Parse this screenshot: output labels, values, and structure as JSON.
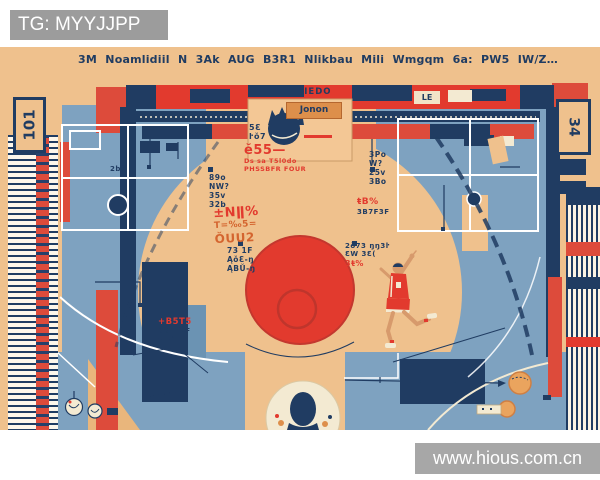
{
  "banners": {
    "telegram": "TG: MYYJJPP",
    "website": "www.hious.com.cn"
  },
  "illustration": {
    "top_words": [
      "3M",
      "Noamlidiil",
      "N",
      "3Ak",
      "AUG",
      "B3R1",
      "Nlikbau",
      "Mili",
      "Wmgqm",
      "6a:",
      "PW5",
      "IW/Z…"
    ],
    "corner_left": "101",
    "corner_right": "34",
    "band": {
      "jonon": "Jonon",
      "piedo": "PIEDO",
      "le": "LE"
    },
    "annotations": {
      "center": {
        "l1": "ĕ55—",
        "l2": "Ds sa T5l0do",
        "l3": "PHSSBFR FOUR"
      },
      "left_red": {
        "l1": "±Nǁ%",
        "l2": "T=‰5=",
        "l3": "ŎUU2"
      },
      "left_navy": {
        "l1": "89o",
        "l2": "NW?",
        "l3": "35v",
        "l4": "32b"
      },
      "mid_navy": {
        "l1": "5Ɛ",
        "l2": "ŀŏ7"
      },
      "right_navy": {
        "l1": "3Po",
        "l2": "W?",
        "l3": "25v",
        "l4": "3Bo"
      },
      "right_red": {
        "l1": "ŧB%",
        "l2": "3B7F3F"
      },
      "mid2": {
        "l1": "2ŏ73 ŋŋ3ŀ",
        "l2": "ƐW 3Ɛ(",
        "l3": "3ŧ%"
      },
      "low_left": {
        "l1": "73 1F",
        "l2": "ĄŏƐ-ŋ",
        "l3": "ĄBŬ-ŋ"
      },
      "bottom_red": {
        "l1": "+B5T5",
        "l2": "3B7F3F",
        "l3": "Ɛ 1ŀ"
      },
      "tiny_left": "2bŏ"
    }
  },
  "colors": {
    "peach": "#efc18d",
    "peach2": "#e9b67c",
    "peach3": "#f3c795",
    "blue": "#7ea2c0",
    "blue2": "#6b93b3",
    "navy": "#203c62",
    "red": "#dd4b3b",
    "red2": "#e23a2e",
    "orange": "#dd8f4b",
    "cream": "#f3ead2",
    "skin": "#d79a6c",
    "banner_gray": "#9c9c9c",
    "white": "#ffffff"
  }
}
